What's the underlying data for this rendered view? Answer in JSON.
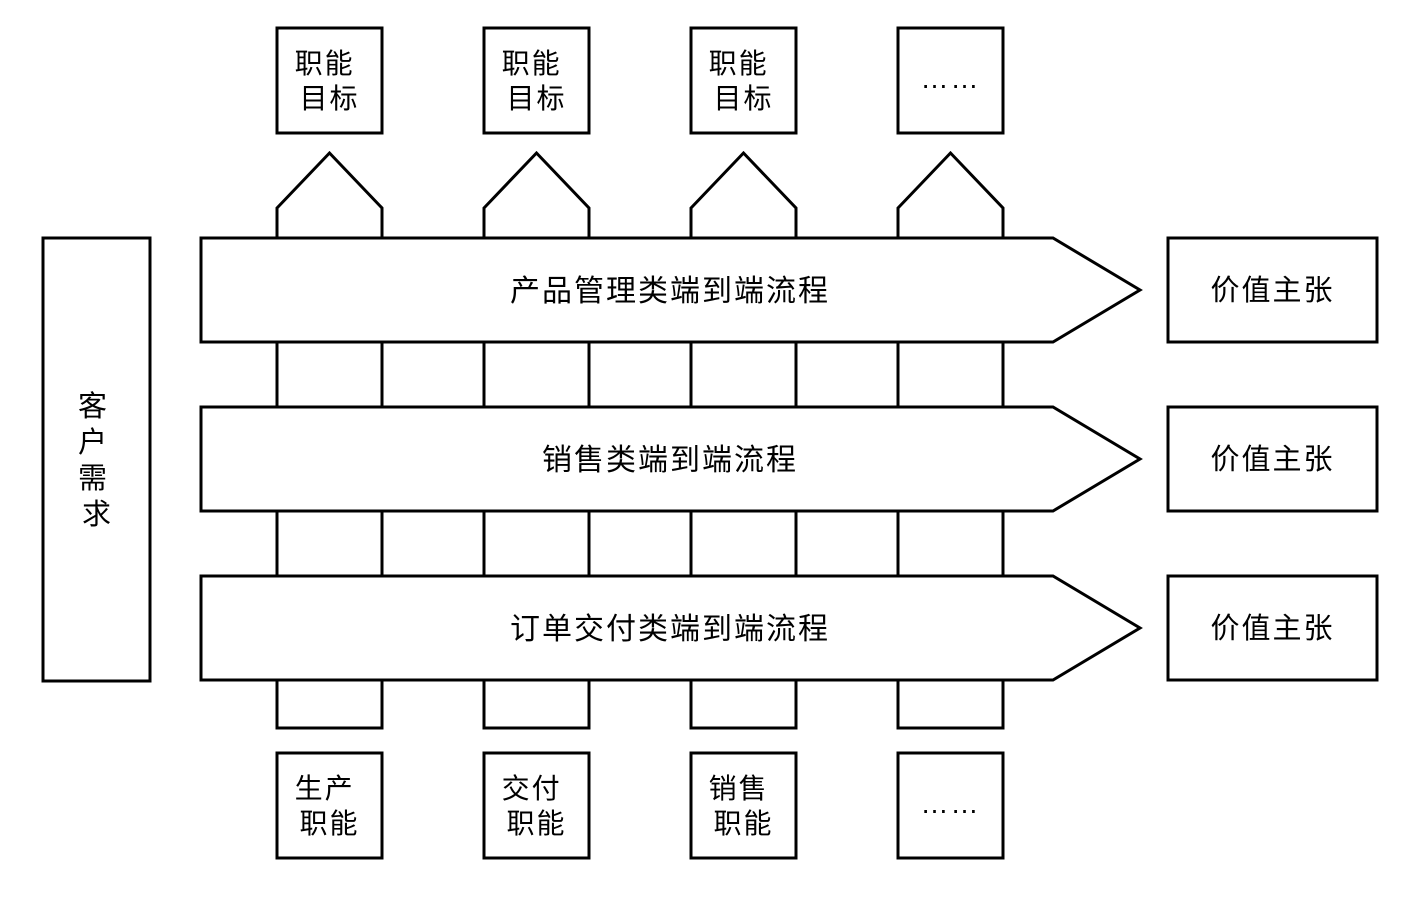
{
  "colors": {
    "background": "#ffffff",
    "line": "#000000",
    "text": "#000000"
  },
  "top_goal_boxes": [
    {
      "lines": [
        "职能",
        "目标"
      ]
    },
    {
      "lines": [
        "职能",
        "目标"
      ]
    },
    {
      "lines": [
        "职能",
        "目标"
      ]
    },
    {
      "lines": [
        "……"
      ]
    }
  ],
  "process_arrows": [
    {
      "label": "产品管理类端到端流程"
    },
    {
      "label": "销售类端到端流程"
    },
    {
      "label": "订单交付类端到端流程"
    }
  ],
  "value_boxes": [
    {
      "label": "价值主张"
    },
    {
      "label": "价值主张"
    },
    {
      "label": "价值主张"
    }
  ],
  "customer_box": {
    "chars": [
      "客",
      "户",
      "需",
      "求"
    ]
  },
  "bottom_function_boxes": [
    {
      "lines": [
        "生产",
        "职能"
      ]
    },
    {
      "lines": [
        "交付",
        "职能"
      ]
    },
    {
      "lines": [
        "销售",
        "职能"
      ]
    },
    {
      "lines": [
        "……"
      ]
    }
  ]
}
